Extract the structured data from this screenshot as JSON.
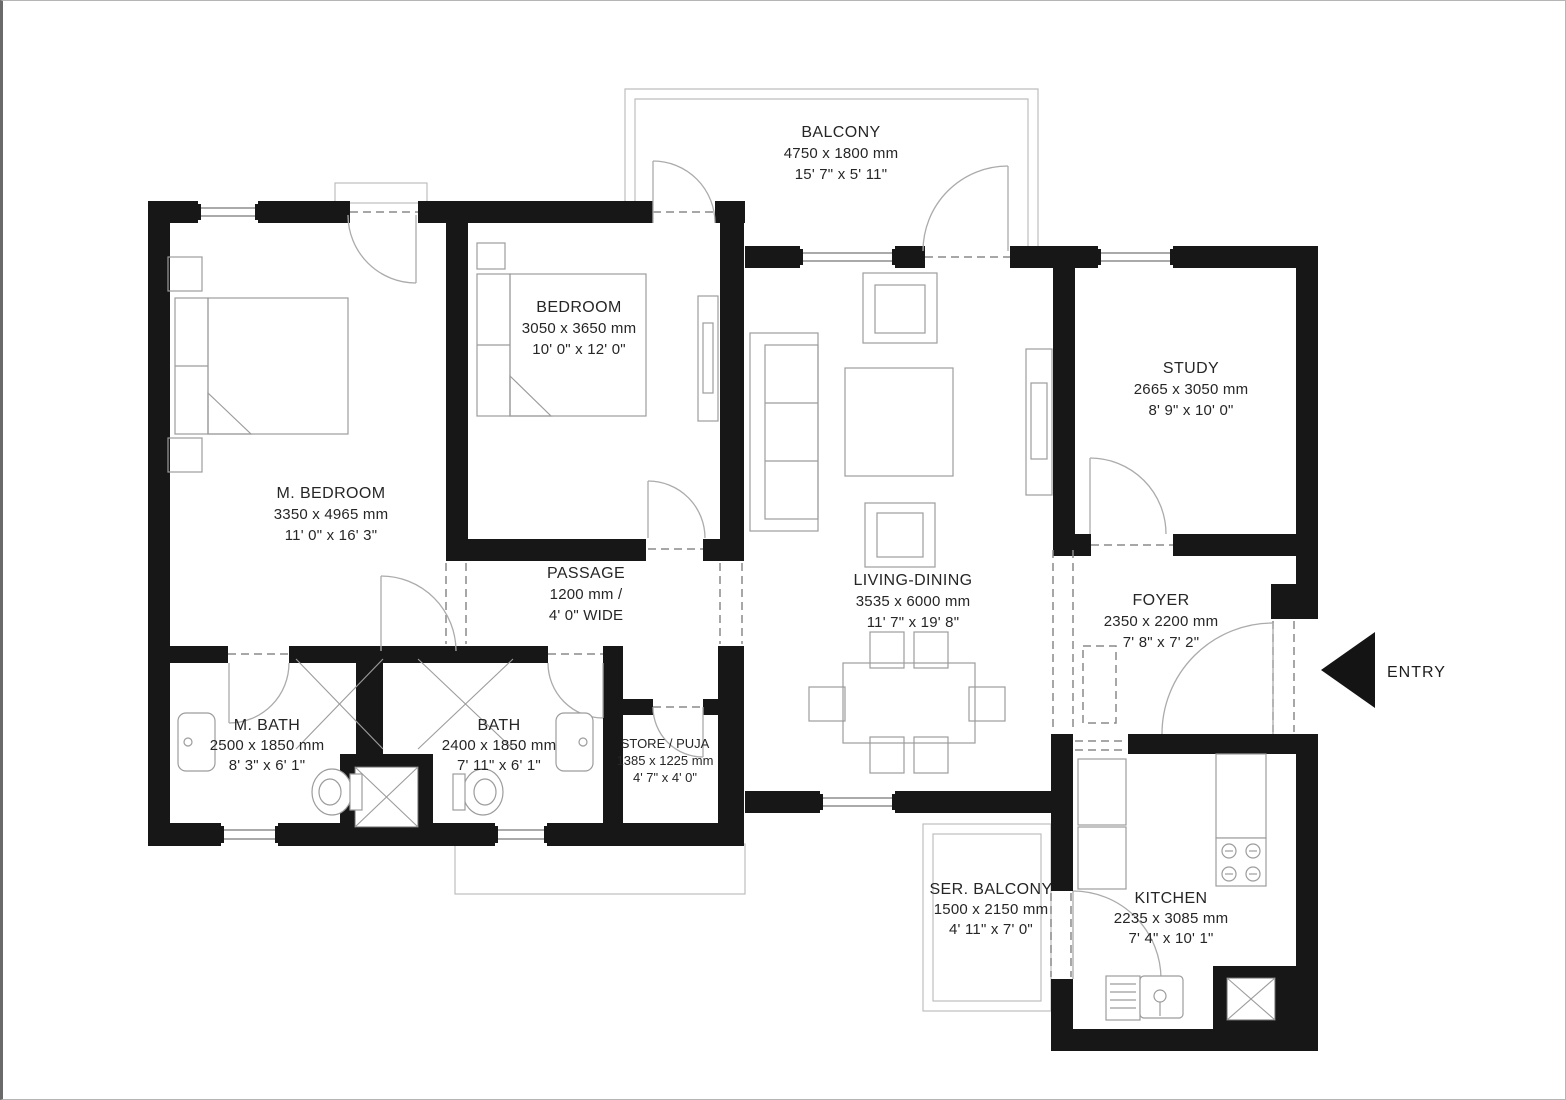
{
  "plan_title": "2BHK + Study Apartment Floor Plan",
  "colors": {
    "wall": "#171717",
    "furniture_line": "#9c9c9c",
    "light_line": "#bdbdbd",
    "text": "#262626"
  },
  "rooms": [
    {
      "id": "balcony",
      "name": "BALCONY",
      "size_mm": "4750 x 1800 mm",
      "size_ft": "15' 7\" x 5' 11\""
    },
    {
      "id": "bedroom",
      "name": "BEDROOM",
      "size_mm": "3050 x 3650 mm",
      "size_ft": "10' 0\" x 12' 0\""
    },
    {
      "id": "m-bedroom",
      "name": "M. BEDROOM",
      "size_mm": "3350 x 4965 mm",
      "size_ft": "11' 0\" x 16' 3\""
    },
    {
      "id": "study",
      "name": "STUDY",
      "size_mm": "2665 x 3050 mm",
      "size_ft": "8' 9\" x 10' 0\""
    },
    {
      "id": "living",
      "name": "LIVING-DINING",
      "size_mm": "3535 x 6000 mm",
      "size_ft": "11' 7\" x 19' 8\""
    },
    {
      "id": "passage",
      "name": "PASSAGE",
      "size_mm": "1200 mm /",
      "size_ft": "4' 0\" WIDE"
    },
    {
      "id": "foyer",
      "name": "FOYER",
      "size_mm": "2350 x 2200 mm",
      "size_ft": "7' 8\" x 7' 2\""
    },
    {
      "id": "m-bath",
      "name": "M. BATH",
      "size_mm": "2500 x 1850 mm",
      "size_ft": "8' 3\" x 6' 1\""
    },
    {
      "id": "bath",
      "name": "BATH",
      "size_mm": "2400 x 1850 mm",
      "size_ft": "7' 11\" x 6' 1\""
    },
    {
      "id": "store",
      "name": "STORE / PUJA",
      "size_mm": "1385 x 1225 mm",
      "size_ft": "4' 7\" x 4' 0\""
    },
    {
      "id": "ser-balcony",
      "name": "SER. BALCONY",
      "size_mm": "1500 x 2150 mm",
      "size_ft": "4' 11\" x 7' 0\""
    },
    {
      "id": "kitchen",
      "name": "KITCHEN",
      "size_mm": "2235 x 3085 mm",
      "size_ft": "7' 4\" x 10' 1\""
    }
  ],
  "entry": {
    "label": "ENTRY"
  }
}
